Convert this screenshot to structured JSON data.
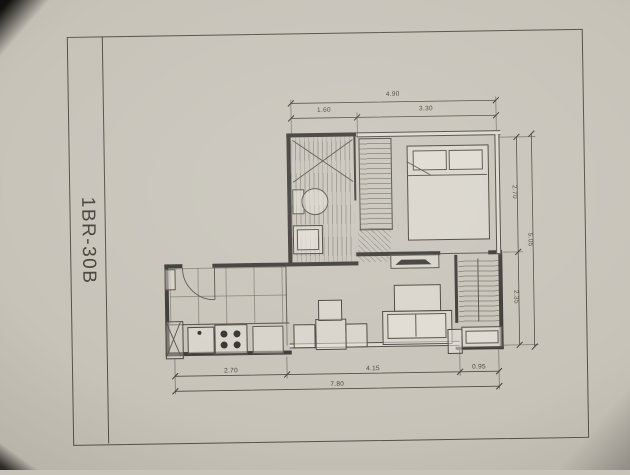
{
  "sheet": {
    "plan_code": "1BR-30B"
  },
  "dimensions": {
    "top": {
      "overall": "4.90",
      "segment_left": "1.60",
      "segment_right": "3.30"
    },
    "right": {
      "segment_upper": "2.70",
      "segment_lower": "2.35",
      "overall": "5.05"
    },
    "bottom": {
      "segment_left": "2.70",
      "segment_middle": "4.15",
      "segment_right": "0.95",
      "overall": "7.80"
    }
  }
}
